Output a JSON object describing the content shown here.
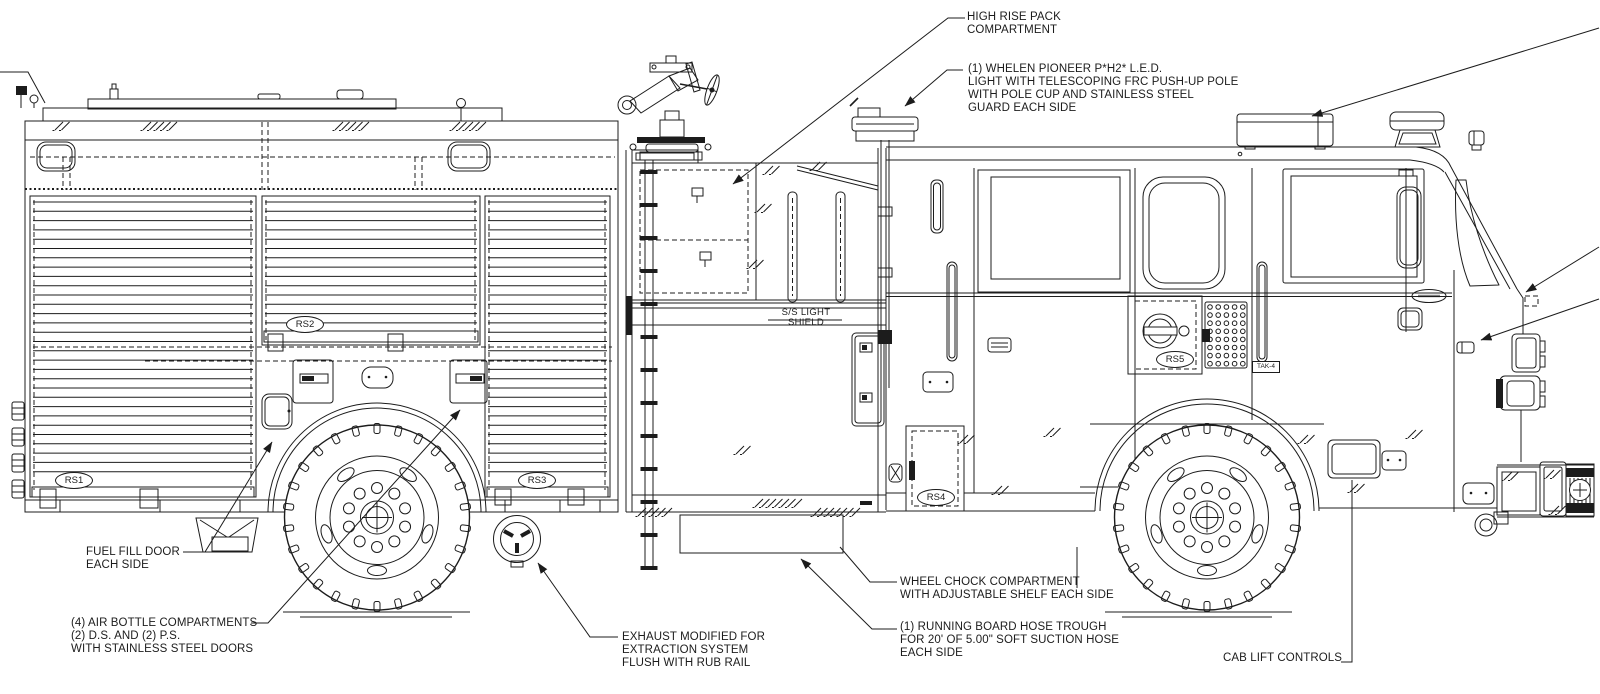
{
  "drawing": {
    "colors": {
      "line": "#1c1c1c",
      "background": "#ffffff"
    },
    "annotations": {
      "high_rise": "HIGH RISE PACK\nCOMPARTMENT",
      "whelen": "(1) WHELEN PIONEER P*H2* L.E.D.\nLIGHT WITH TELESCOPING FRC PUSH-UP POLE\nWITH POLE CUP AND STAINLESS STEEL\nGUARD EACH SIDE",
      "light_shield": "S/S LIGHT SHIELD",
      "fuel_fill": "FUEL FILL DOOR\nEACH SIDE",
      "air_bottle": "(4) AIR BOTTLE COMPARTMENTS\n(2) D.S. AND (2) P.S.\nWITH STAINLESS STEEL DOORS",
      "exhaust": "EXHAUST MODIFIED FOR\nEXTRACTION SYSTEM\nFLUSH WITH RUB RAIL",
      "wheel_chock": "WHEEL CHOCK COMPARTMENT\nWITH ADJUSTABLE SHELF EACH SIDE",
      "hose_trough": "(1) RUNNING BOARD HOSE TROUGH\nFOR 20' OF 5.00\" SOFT SUCTION HOSE\nEACH SIDE",
      "cab_lift": "CAB LIFT CONTROLS"
    },
    "labels": {
      "rs1": "RS1",
      "rs2": "RS2",
      "rs3": "RS3",
      "rs4": "RS4",
      "rs5": "RS5",
      "tak4": "TAK-4"
    }
  }
}
